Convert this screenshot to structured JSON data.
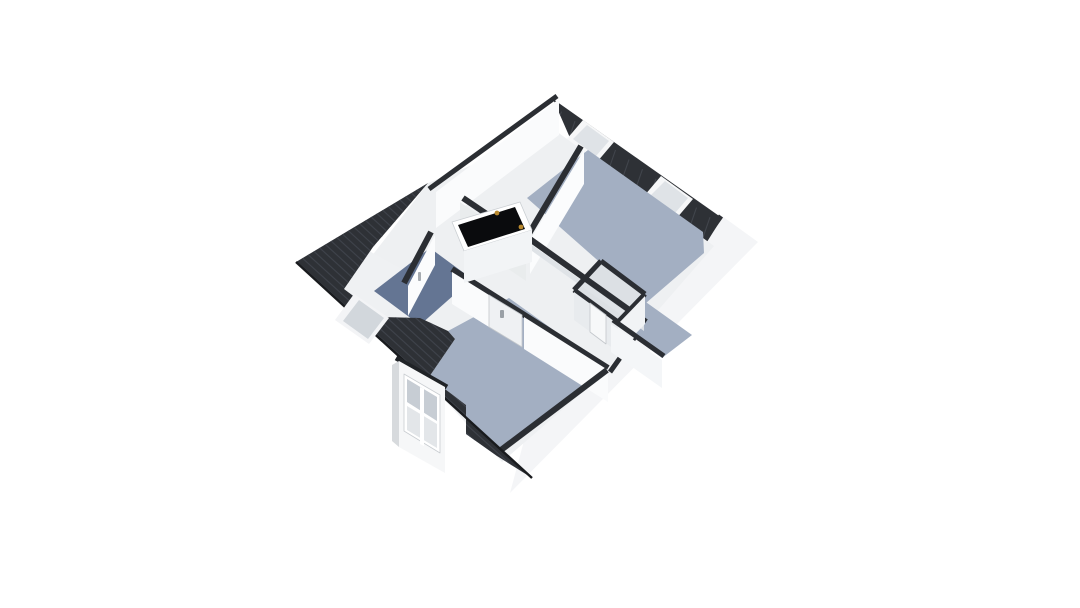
{
  "meta": {
    "kind": "3d-floor-plan-render",
    "background": "#ffffff"
  },
  "palette": {
    "roof_dark": "#2e3136",
    "roof_tile_line": "#3e424a",
    "wall_cap_dark": "#2b2e33",
    "wall_white": "#fafbfc",
    "wall_shaded": "#e8ebee",
    "floor_blue": "#a3afc2",
    "floor_navy": "#647593",
    "floor_light": "#eef0f2",
    "closet_floor": "#dce0e4",
    "glass": "#ccd2d8",
    "stair_void": "#0a0b0d",
    "hinge_gold": "#b9892e"
  },
  "rooms": [
    {
      "name": "room-top-right",
      "floor": "#a3afc2"
    },
    {
      "name": "room-bottom",
      "floor": "#a3afc2"
    },
    {
      "name": "room-top-left",
      "floor": "#eef0f2"
    },
    {
      "name": "bathroom-left",
      "floor": "#eff1f3"
    },
    {
      "name": "landing-hall",
      "floor": "#647593"
    },
    {
      "name": "closet-middle",
      "floor": "#dce0e4"
    }
  ],
  "features": [
    "stair-opening",
    "dormer-window",
    "roof-window-ne-1",
    "roof-window-ne-2",
    "roof-window-nw",
    "door-handles"
  ],
  "scene": {
    "viewbox": [
      0,
      0,
      1080,
      608
    ],
    "shapes": [
      {
        "t": "poly",
        "n": "se-exterior-wall-band",
        "p": [
          722,
          216,
          758,
          242,
          510,
          493,
          540,
          381,
          706,
          231
        ],
        "f": "#f4f5f7"
      },
      {
        "t": "bar",
        "n": "se-wall-cap",
        "p": [
          721,
          216,
          610,
          372,
          5
        ],
        "f": "#2b2e33"
      },
      {
        "t": "poly",
        "n": "roof-ne-slope",
        "p": [
          553,
          99,
          722,
          218,
          700,
          253,
          574,
          147
        ],
        "f": "#2e3136",
        "clip": true
      },
      {
        "t": "hatch",
        "n": "roof-ne-tiles",
        "clip": "roof-ne-slope",
        "start": [
          548,
          102
        ],
        "step": [
          13.5,
          9.6
        ],
        "dir": [
          -16,
          46
        ],
        "count": 14,
        "s": "#41454c",
        "sw": 1.1
      },
      {
        "t": "bar",
        "n": "roof-ne-inner-edge",
        "p": [
          574,
          147,
          700,
          252,
          3
        ],
        "f": "#202329"
      },
      {
        "t": "poly",
        "n": "roof-window-ne-1-frame",
        "p": [
          583,
          120,
          614,
          142,
          597,
          162,
          566,
          140
        ],
        "f": "#f6f7f8"
      },
      {
        "t": "poly",
        "n": "roof-window-ne-1-glass",
        "p": [
          587,
          125,
          609,
          141,
          596,
          156,
          573,
          139
        ],
        "f": "#dfe3e7"
      },
      {
        "t": "poly",
        "n": "roof-window-ne-2-frame",
        "p": [
          661,
          176,
          693,
          199,
          676,
          219,
          644,
          196
        ],
        "f": "#f6f7f8"
      },
      {
        "t": "poly",
        "n": "roof-window-ne-2-glass",
        "p": [
          665,
          181,
          688,
          198,
          675,
          213,
          651,
          195
        ],
        "f": "#dfe3e7"
      },
      {
        "t": "poly",
        "n": "floor-base",
        "p": [
          556,
          131,
          714,
          246,
          600,
          377,
          502,
          462,
          428,
          382,
          338,
          300,
          428,
          183
        ],
        "f": "#eef0f2"
      },
      {
        "t": "poly",
        "n": "nw-wall-face",
        "p": [
          559,
          99,
          436,
          192,
          436,
          228,
          559,
          135
        ],
        "f": "#fafbfc"
      },
      {
        "t": "bar",
        "n": "nw-wall-cap",
        "p": [
          557,
          96,
          429,
          189,
          5
        ],
        "f": "#2b2e33"
      },
      {
        "t": "poly",
        "n": "floor-room-top-right",
        "p": [
          588,
          150,
          703,
          232,
          704,
          253,
          646,
          303,
          527,
          198
        ],
        "f": "#a3afc2"
      },
      {
        "t": "poly",
        "n": "floor-room-top-right-arm",
        "p": [
          643,
          300,
          692,
          335,
          662,
          358,
          613,
          322
        ],
        "f": "#a3afc2"
      },
      {
        "t": "poly",
        "n": "floor-closet",
        "p": [
          601,
          263,
          644,
          294,
          617,
          322,
          575,
          291
        ],
        "f": "#dce0e4"
      },
      {
        "t": "poly",
        "n": "floor-bathroom",
        "p": [
          362,
          247,
          422,
          280,
          381,
          317,
          344,
          289
        ],
        "f": "#eff1f3"
      },
      {
        "t": "poly",
        "n": "floor-landing-navy",
        "p": [
          430,
          248,
          472,
          279,
          420,
          325,
          374,
          291
        ],
        "f": "#647593"
      },
      {
        "t": "poly",
        "n": "floor-navy-sliver",
        "p": [
          400,
          291,
          421,
          279,
          432,
          291,
          411,
          303
        ],
        "f": "#647593"
      },
      {
        "t": "poly",
        "n": "floor-room-bottom",
        "p": [
          509,
          298,
          608,
          369,
          497,
          456,
          466,
          434,
          466,
          405,
          429,
          377,
          455,
          339,
          448,
          331
        ],
        "f": "#a3afc2"
      },
      {
        "t": "bar",
        "n": "wall-a-cap",
        "p": [
          581,
          146,
          527,
          237,
          6
        ],
        "f": "#2b2e33"
      },
      {
        "t": "poly",
        "n": "wall-a-face",
        "p": [
          584,
          150,
          530,
          240,
          530,
          274,
          584,
          184
        ],
        "f": "#fbfcfd"
      },
      {
        "t": "bar",
        "n": "wall-g-cap",
        "p": [
          463,
          198,
          528,
          242,
          6
        ],
        "f": "#2b2e33"
      },
      {
        "t": "poly",
        "n": "wall-g-face",
        "p": [
          460,
          202,
          526,
          247,
          526,
          281,
          460,
          236
        ],
        "f": "#e9eced"
      },
      {
        "t": "bar",
        "n": "wall-b-cap",
        "p": [
          527,
          237,
          646,
          322,
          6
        ],
        "f": "#2b2e33"
      },
      {
        "t": "poly",
        "n": "wall-b-face",
        "p": [
          525,
          240,
          644,
          325,
          644,
          331,
          525,
          246
        ],
        "f": "#dfe3e7"
      },
      {
        "t": "bar",
        "n": "closet-cap-nw",
        "p": [
          601,
          261,
          574,
          290,
          5
        ],
        "f": "#2b2e33"
      },
      {
        "t": "bar",
        "n": "closet-cap-ne",
        "p": [
          601,
          261,
          645,
          294,
          5
        ],
        "f": "#2b2e33"
      },
      {
        "t": "bar",
        "n": "closet-cap-se",
        "p": [
          645,
          294,
          618,
          322,
          5
        ],
        "f": "#2b2e33"
      },
      {
        "t": "bar",
        "n": "closet-cap-sw",
        "p": [
          574,
          290,
          618,
          322,
          5
        ],
        "f": "#2b2e33"
      },
      {
        "t": "poly",
        "n": "closet-face-se",
        "p": [
          645,
          296,
          618,
          324,
          618,
          352,
          645,
          324
        ],
        "f": "#f1f3f5"
      },
      {
        "t": "poly",
        "n": "closet-face-sw",
        "p": [
          574,
          292,
          618,
          324,
          618,
          352,
          574,
          320
        ],
        "f": "#e8ebee"
      },
      {
        "t": "poly",
        "n": "closet-door-leaf",
        "p": [
          590,
          303,
          606,
          315,
          606,
          344,
          590,
          332
        ],
        "f": "#f7f8f9",
        "s": "#c3c7cb",
        "sw": 0.8
      },
      {
        "t": "bar",
        "n": "arm-sw-cap",
        "p": [
          613,
          320,
          664,
          356,
          5
        ],
        "f": "#2b2e33"
      },
      {
        "t": "poly",
        "n": "arm-sw-face",
        "p": [
          611,
          324,
          662,
          360,
          662,
          388,
          611,
          352
        ],
        "f": "#f4f6f8"
      },
      {
        "t": "bar",
        "n": "wall-d-cap",
        "p": [
          452,
          269,
          608,
          368,
          6
        ],
        "f": "#2b2e33"
      },
      {
        "t": "poly",
        "n": "wall-d-face-left",
        "p": [
          452,
          272,
          489,
          295,
          489,
          327,
          452,
          304
        ],
        "f": "#fafbfc"
      },
      {
        "t": "poly",
        "n": "wall-d-face-right",
        "p": [
          524,
          317,
          608,
          370,
          608,
          402,
          524,
          349
        ],
        "f": "#fafbfc"
      },
      {
        "t": "poly",
        "n": "door-leaf-room-bottom",
        "p": [
          489,
          295,
          522,
          315,
          522,
          347,
          489,
          327
        ],
        "f": "#eff1f3",
        "s": "#c3c7cb",
        "sw": 0.8
      },
      {
        "t": "rect",
        "n": "door-handle-room-bottom",
        "p": [
          500,
          310,
          4,
          8
        ],
        "f": "#9aa0a6"
      },
      {
        "t": "bar",
        "n": "wall-e-cap",
        "p": [
          431,
          232,
          404,
          283,
          6
        ],
        "f": "#2b2e33"
      },
      {
        "t": "poly",
        "n": "wall-e-face",
        "p": [
          435,
          235,
          408,
          286,
          408,
          316,
          435,
          265
        ],
        "f": "#fbfcfd"
      },
      {
        "t": "rect",
        "n": "door-handle-bathroom",
        "p": [
          418,
          272,
          3,
          9
        ],
        "f": "#a6abb0"
      },
      {
        "t": "bar",
        "n": "se-knee-cap",
        "p": [
          607,
          370,
          497,
          453,
          6
        ],
        "f": "#2b2e33"
      },
      {
        "t": "poly",
        "n": "stair-rim",
        "p": [
          452,
          222,
          520,
          202,
          532,
          230,
          464,
          251
        ],
        "f": "#ffffff",
        "s": "#caced2",
        "sw": 0.8
      },
      {
        "t": "poly",
        "n": "stair-void",
        "p": [
          458,
          225,
          515,
          207,
          525,
          229,
          468,
          247
        ],
        "f": "#0a0b0d"
      },
      {
        "t": "poly",
        "n": "stair-under-face",
        "p": [
          464,
          251,
          532,
          230,
          532,
          262,
          464,
          283
        ],
        "f": "#f2f4f6"
      },
      {
        "t": "circle",
        "n": "stair-hinge-1",
        "p": [
          497,
          213,
          2.4
        ],
        "f": "#b9892e"
      },
      {
        "t": "circle",
        "n": "stair-hinge-2",
        "p": [
          521,
          227,
          2.4
        ],
        "f": "#b9892e"
      },
      {
        "t": "poly",
        "n": "roof-sw-slope",
        "p": [
          428,
          183,
          296,
          262,
          532,
          478,
          497,
          456,
          466,
          434,
          466,
          405,
          429,
          377,
          455,
          339,
          448,
          331,
          420,
          318,
          381,
          317,
          344,
          289,
          373,
          247
        ],
        "f": "#2e3136",
        "clip": true
      },
      {
        "t": "hatch",
        "n": "roof-sw-tiles",
        "clip": "roof-sw-slope",
        "start": [
          60,
          150
        ],
        "step": [
          9.5,
          0
        ],
        "dir": [
          430,
          391
        ],
        "count": 46,
        "s": "#3e424a",
        "sw": 1.2
      },
      {
        "t": "bar",
        "n": "roof-sw-eave-edge",
        "p": [
          296,
          262,
          532,
          478,
          2.4
        ],
        "f": "#191b1e"
      },
      {
        "t": "bar",
        "n": "dormer-top-cap",
        "p": [
          396,
          358,
          447,
          387,
          5
        ],
        "f": "#202327"
      },
      {
        "t": "poly",
        "n": "dormer-face",
        "p": [
          399,
          361,
          445,
          387,
          445,
          473,
          399,
          447
        ],
        "f": "#f6f7f8"
      },
      {
        "t": "poly",
        "n": "dormer-side",
        "p": [
          392,
          365,
          399,
          361,
          399,
          447,
          392,
          441
        ],
        "f": "#d7dadd"
      },
      {
        "t": "poly",
        "n": "dormer-window-frame",
        "p": [
          404,
          374,
          440,
          395,
          440,
          453,
          404,
          431
        ],
        "f": "#ffffff",
        "s": "#c9cdd1",
        "sw": 0.8
      },
      {
        "t": "poly",
        "n": "dormer-window-glass-upper",
        "p": [
          407,
          379,
          437,
          397,
          437,
          421,
          407,
          402
        ],
        "f": "#c7cdd4"
      },
      {
        "t": "poly",
        "n": "dormer-window-glass-lower",
        "p": [
          407,
          406,
          437,
          424,
          437,
          448,
          407,
          430
        ],
        "f": "#e3e6e9"
      },
      {
        "t": "poly",
        "n": "dormer-window-mullion",
        "p": [
          420,
          387,
          424,
          389,
          424,
          446,
          420,
          444
        ],
        "f": "#ffffff"
      },
      {
        "t": "poly",
        "n": "roof-window-nw-frame",
        "p": [
          354,
          294,
          389,
          318,
          369,
          344,
          335,
          320
        ],
        "f": "#f3f4f6"
      },
      {
        "t": "poly",
        "n": "roof-window-nw-glass",
        "p": [
          359,
          300,
          384,
          318,
          368,
          339,
          343,
          321
        ],
        "f": "#d2d7dc"
      }
    ]
  }
}
